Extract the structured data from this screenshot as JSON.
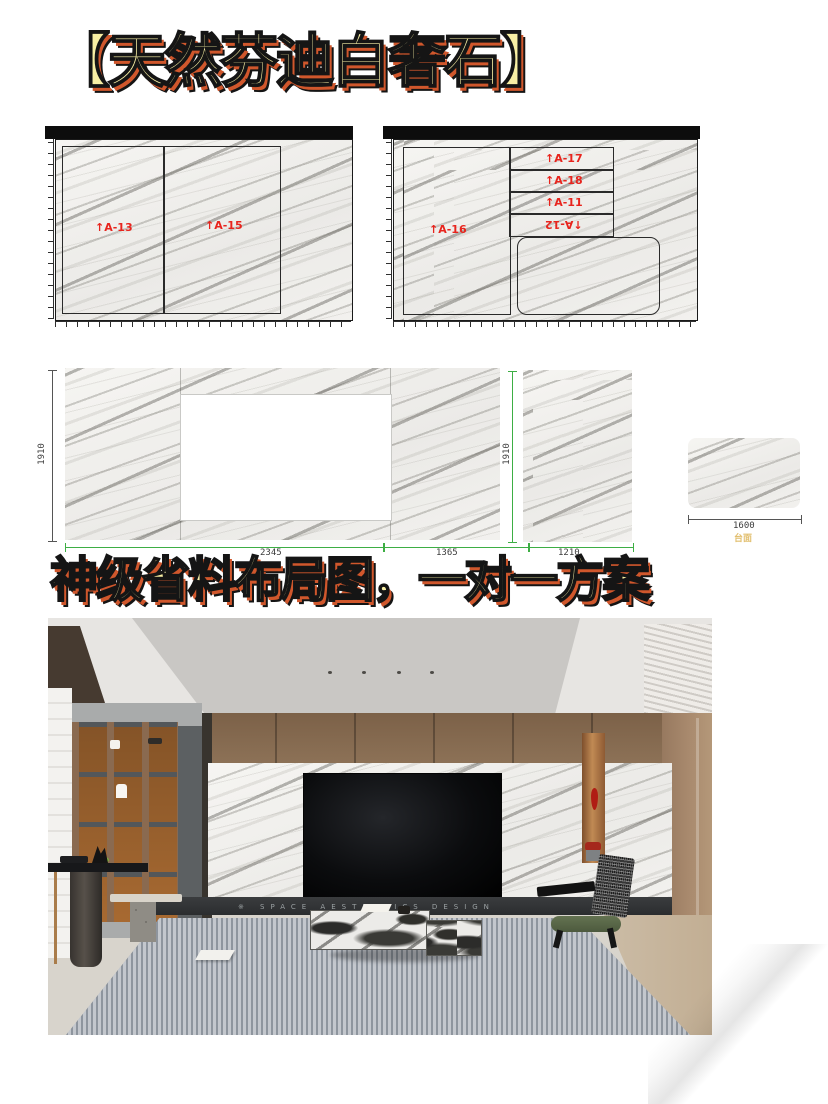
{
  "title": "【天然芬迪白奢石】",
  "subtitle": "神级省料布局图，一对一方案",
  "slabs": {
    "slab1": {
      "pieces": [
        "↑A-13",
        "↑A-15"
      ]
    },
    "slab2": {
      "piece_left": "↑A-16",
      "strips": [
        "↑A-17",
        "↑A-18",
        "↑A-11",
        "↑A-12"
      ]
    }
  },
  "panel_layout": {
    "height_left": "1910",
    "height_right": "1910",
    "width_main": "2345",
    "width_mid": "1365",
    "width_side": "1210",
    "width_top": "1600",
    "countertop_label": "台面"
  },
  "photo": {
    "plinth_mark": "※",
    "plinth_text": "SPACE AESTHETICS DESIGN"
  },
  "colors": {
    "accent_red": "#e8241d",
    "dim_green": "#3dae44",
    "title_fill": "#f8efa4",
    "title_shadow": "#d0572c",
    "countertop_yellow": "#e2bf6f"
  }
}
